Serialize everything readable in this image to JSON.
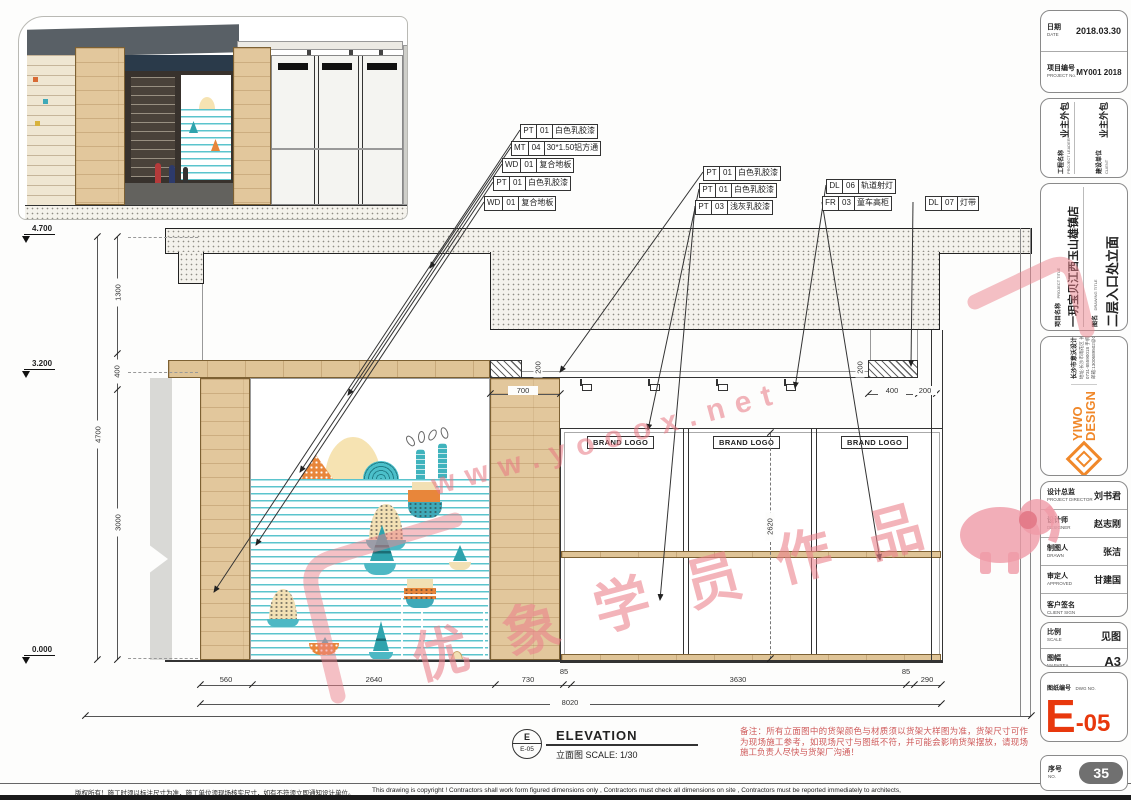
{
  "drawing": {
    "levels": {
      "top": "4.700",
      "mid": "3.200",
      "base": "0.000"
    },
    "vdims": {
      "seg1": "1300",
      "seg2": "400",
      "seg3": "3000",
      "total": "4700",
      "glass": "2620",
      "c200a": "200",
      "c200b": "200"
    },
    "hdims": {
      "d700": "700",
      "d400": "400",
      "d200": "200",
      "b1": "560",
      "b2": "2640",
      "b3": "730",
      "b4": "85",
      "b5": "3630",
      "b6": "85",
      "b7": "290",
      "total": "8020"
    },
    "brand_logo": "BRAND LOGO",
    "tags": [
      {
        "code": "PT",
        "num": "01",
        "name": "白色乳胶漆"
      },
      {
        "code": "MT",
        "num": "04",
        "name": "30*1.50铝方通"
      },
      {
        "code": "WD",
        "num": "01",
        "name": "复合地板"
      },
      {
        "code": "PT",
        "num": "01",
        "name": "白色乳胶漆"
      },
      {
        "code": "WD",
        "num": "01",
        "name": "复合地板"
      },
      {
        "code": "PT",
        "num": "01",
        "name": "白色乳胶漆"
      },
      {
        "code": "PT",
        "num": "01",
        "name": "白色乳胶漆"
      },
      {
        "code": "PT",
        "num": "03",
        "name": "浅灰乳胶漆"
      },
      {
        "code": "DL",
        "num": "06",
        "name": "轨道射灯"
      },
      {
        "code": "FR",
        "num": "03",
        "name": "童车高柜"
      },
      {
        "code": "DL",
        "num": "07",
        "name": "灯带"
      }
    ],
    "callout": {
      "letter": "E",
      "sheet": "E-05",
      "title": "ELEVATION",
      "subtitle": "立面图 SCALE: 1/30"
    },
    "red_note": "备注：所有立面图中的货架颜色与材质须以货架大样图为准，货架尺寸可作为现场施工参考，如现场尺寸与图纸不符，并可能会影响货架摆放，请现场施工负责人尽快与货架厂沟通！"
  },
  "watermark": {
    "url": "www.yooox.net",
    "brand": "优象学员作品"
  },
  "titleblock": {
    "date_cn": "日期",
    "date_en": "DATE",
    "date_val": "2018.03.30",
    "projno_cn": "项目编号",
    "projno_en": "PROJECT No.",
    "projno_val": "MY001 2018",
    "leader_cn": "工程名称",
    "leader_en": "PROJECT LEADER",
    "leader_val": "业主外包",
    "client_cn": "建设单位",
    "client_en": "CLIENT",
    "client_val": "业主外包",
    "proj_cn": "项目名称",
    "proj_en": "PROJECT TITLE",
    "proj_val": "一玥宝贝江西玉山雄镇店",
    "dwg_cn": "图名",
    "dwg_en": "DRAWING TITLE",
    "dwg_val": "二层入口处立面",
    "logo1": "YIWO",
    "logo2": "DESIGN",
    "studio": "长沙市意沃设计工作室",
    "addr": "地址:长沙市雨花区 长沙大道米兰春天1栋902室",
    "phone": "0731-85590018 手机:18973138232",
    "email": "邮箱:1300689502@QQ.com",
    "director_cn": "设计总监",
    "director_en": "PROJECT DIRECTOR",
    "director_val": "刘书君",
    "designer_cn": "设计师",
    "designer_en": "DESIGNER",
    "designer_val": "赵志刚",
    "drawn_cn": "制图人",
    "drawn_en": "DRAWN",
    "drawn_val": "张洁",
    "approved_cn": "审定人",
    "approved_en": "APPROVED",
    "approved_val": "甘建国",
    "clientsign_cn": "客户签名",
    "clientsign_en": "CLIENT SIGN",
    "clientsign_val": "",
    "scale_cn": "比例",
    "scale_en": "SCALE",
    "scale_val": "见图",
    "size_cn": "图幅",
    "size_en": "MAPAREA",
    "size_val": "A3",
    "dwgno_cn": "图纸编号",
    "dwgno_en": "DWG NO.",
    "dwgno_main": "E",
    "dwgno_sub": "-05",
    "serial_cn": "序号",
    "serial_en": "NO.",
    "serial_val": "35"
  },
  "footer": {
    "cn": "版权所有！施工时须以标注尺寸为准，施工单位须现场核实尺寸，如有不符须立即通知设计单位。",
    "en": "This drawing is copyright ! Contractors shall work form figured dimensions only , Contractors must check all dimensions on site , Contractors must be reported immediately to architects,"
  }
}
